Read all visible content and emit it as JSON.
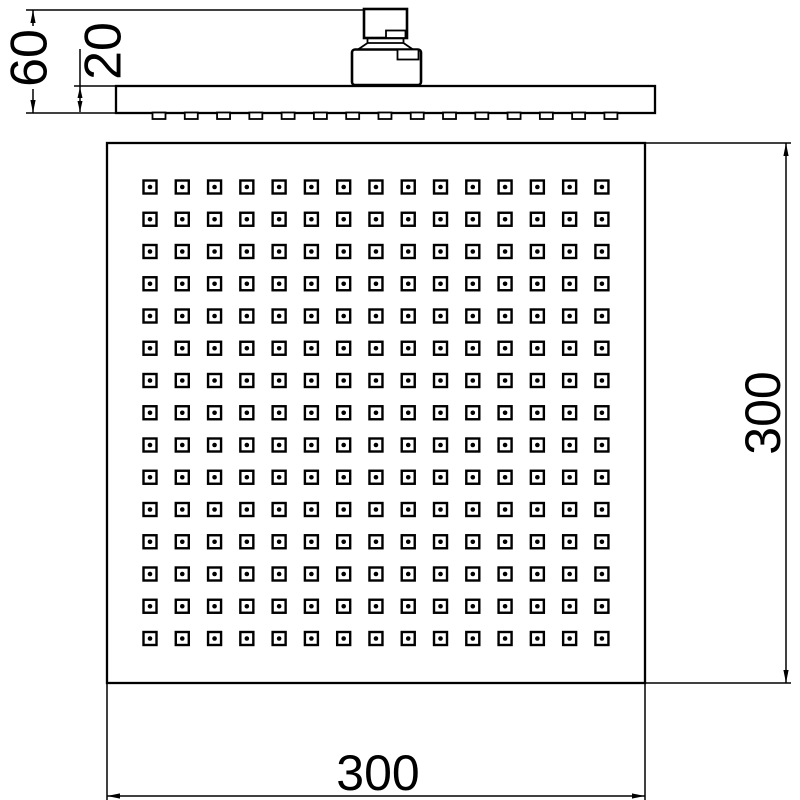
{
  "drawing": {
    "type": "technical-drawing",
    "subject": "square-overhead-shower-head",
    "background": "#ffffff",
    "line_color": "#000000"
  },
  "dimensions": {
    "total_height": {
      "value": "60"
    },
    "plate_thickness": {
      "value": "20"
    },
    "plate_height": {
      "value": "300"
    },
    "plate_width": {
      "value": "300"
    }
  },
  "front_view": {
    "nozzle_grid": {
      "rows": 15,
      "cols": 15,
      "start_x": 150,
      "start_y": 187,
      "spacing_x": 32.28,
      "spacing_y": 32.25,
      "nozzle_size": 13,
      "dot_radius": 2.3
    }
  },
  "side_view": {
    "nozzle_tabs": {
      "count": 15,
      "start_x": 159,
      "spacing": 32.28,
      "y": 112.5,
      "width": 13,
      "height": 6.5
    }
  }
}
